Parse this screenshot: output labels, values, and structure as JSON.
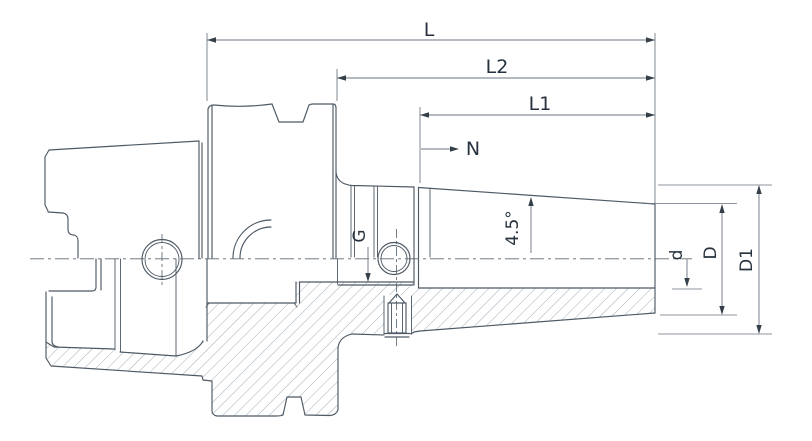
{
  "drawing": {
    "kind": "engineering half-section drawing of a shrink-fit tool holder (hollow taper shank)",
    "labels": {
      "L": "L",
      "L2": "L2",
      "L1": "L1",
      "N": "N",
      "G": "G",
      "angle": "4.5°",
      "d": "d",
      "D": "D",
      "D1": "D1"
    }
  },
  "colors": {
    "background": "#ffffff",
    "outline": "#4d5964",
    "dimension_line": "#6a7480",
    "text": "#26323e",
    "hatch": "#9aa5af"
  }
}
